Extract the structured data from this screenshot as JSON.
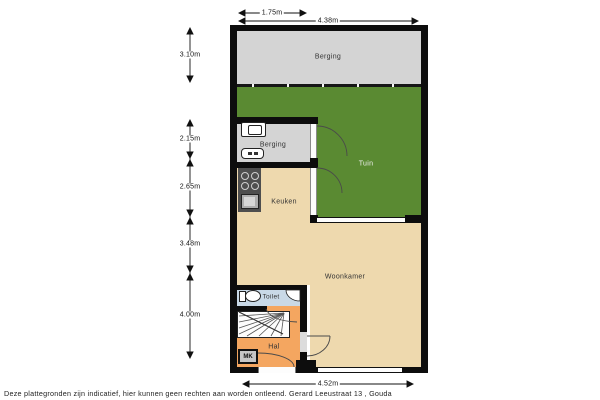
{
  "plan": {
    "rooms": {
      "berging_outdoor": "Berging",
      "berging_indoor": "Berging",
      "tuin": "Tuin",
      "keuken": "Keuken",
      "woonkamer": "Woonkamer",
      "toilet": "Toilet",
      "hal": "Hal",
      "meterkast": "MK"
    },
    "colors": {
      "wall": "#0d0d0d",
      "storage_gray": "#d4d4d4",
      "garden_green": "#5a8a32",
      "floor_beige": "#eed9ae",
      "hall_orange": "#f4a660",
      "toilet_blue": "#c9d9e7",
      "counter_dark": "#4e4e4e"
    }
  },
  "dimensions": {
    "left": [
      "3.10m",
      "2.15m",
      "2.65m",
      "3.48m",
      "4.00m"
    ],
    "top": [
      "1.75m",
      "4.38m"
    ],
    "bottom": [
      "4.52m"
    ]
  },
  "footer": {
    "disclaimer": "Deze plattegronden zijn indicatief, hier kunnen geen rechten aan worden ontleend. Gerard Leeustraat 13 , Gouda"
  }
}
